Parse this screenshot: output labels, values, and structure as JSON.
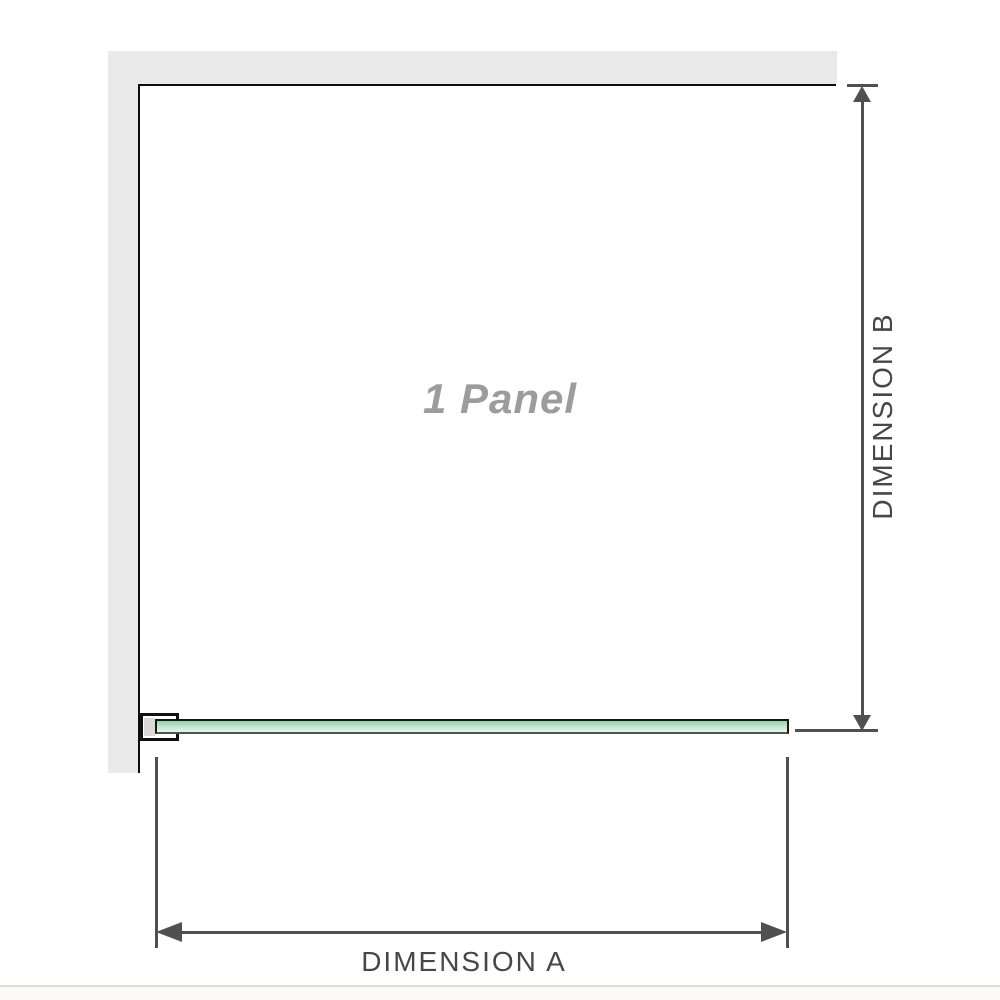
{
  "diagram": {
    "panel_label": "1 Panel",
    "dimension_a": {
      "label": "DIMENSION A"
    },
    "dimension_b": {
      "label": "DIMENSION B"
    }
  },
  "icons": {
    "dimension_b_top": "arrow-up-icon",
    "dimension_b_bottom": "arrow-down-icon",
    "dimension_a_left": "arrow-left-icon",
    "dimension_a_right": "arrow-right-icon"
  },
  "colors": {
    "wall": "#e9e9e9",
    "panel_line": "#0d0d0d",
    "dim_line": "#505050",
    "dim_text": "#474747",
    "panel_label_text": "#9c9c9c",
    "glass_border": "#161616",
    "glass_top": "#94cda8",
    "glass_mid": "#c6e7d3",
    "glass_pale": "#e9f5ee",
    "clamp_fill": "#ffffff",
    "clamp_block": "#d9d9d9",
    "page_divider": "#dedbd4",
    "page_below": "#fbfaf7"
  }
}
